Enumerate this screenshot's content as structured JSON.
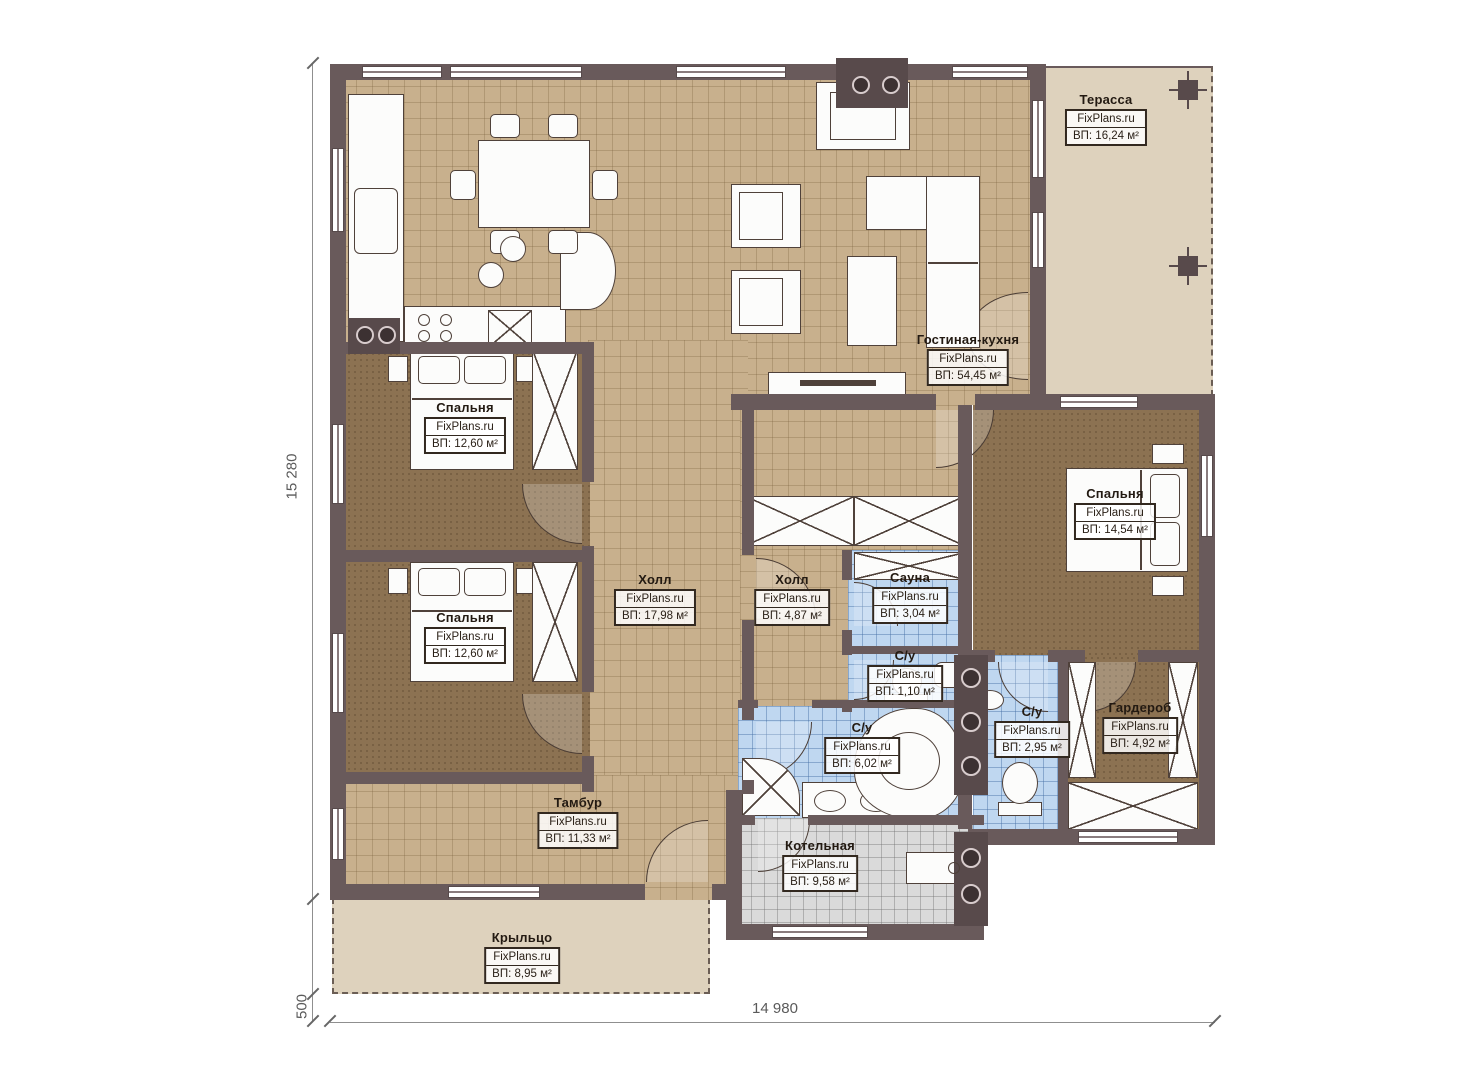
{
  "watermark": "FixPlans.ru",
  "rooms": {
    "terrace": {
      "name": "Терасса",
      "area": "ВП: 16,24 м²"
    },
    "living_kitchen": {
      "name": "Гостиная-кухня",
      "area": "ВП: 54,45 м²"
    },
    "bedroom_top": {
      "name": "Спальня",
      "area": "ВП: 12,60 м²"
    },
    "bedroom_bottom": {
      "name": "Спальня",
      "area": "ВП: 12,60 м²"
    },
    "bedroom_right": {
      "name": "Спальня",
      "area": "ВП: 14,54 м²"
    },
    "hall_main": {
      "name": "Холл",
      "area": "ВП: 17,98 м²"
    },
    "hall_small": {
      "name": "Холл",
      "area": "ВП: 4,87 м²"
    },
    "sauna": {
      "name": "Сауна",
      "area": "ВП: 3,04 м²"
    },
    "wc_small": {
      "name": "С/у",
      "area": "ВП: 1,10 м²"
    },
    "bathroom": {
      "name": "С/у",
      "area": "ВП: 6,02 м²"
    },
    "wc_master": {
      "name": "С/у",
      "area": "ВП: 2,95 м²"
    },
    "wardrobe": {
      "name": "Гардероб",
      "area": "ВП: 4,92 м²"
    },
    "vestibule": {
      "name": "Тамбур",
      "area": "ВП: 11,33 м²"
    },
    "boiler": {
      "name": "Котельная",
      "area": "ВП: 9,58 м²"
    },
    "porch": {
      "name": "Крыльцо",
      "area": "ВП: 8,95 м²"
    }
  },
  "dimensions": {
    "left": "15 280",
    "bottom": "14 980",
    "porch_offset": "500"
  },
  "colors": {
    "wall": "#695a5b",
    "floor_tile": "#c8b08d",
    "floor_carpet": "#8c7252",
    "floor_wet": "#bfd7f0",
    "floor_tech": "#dadada",
    "floor_outdoor": "#ded2bd"
  }
}
